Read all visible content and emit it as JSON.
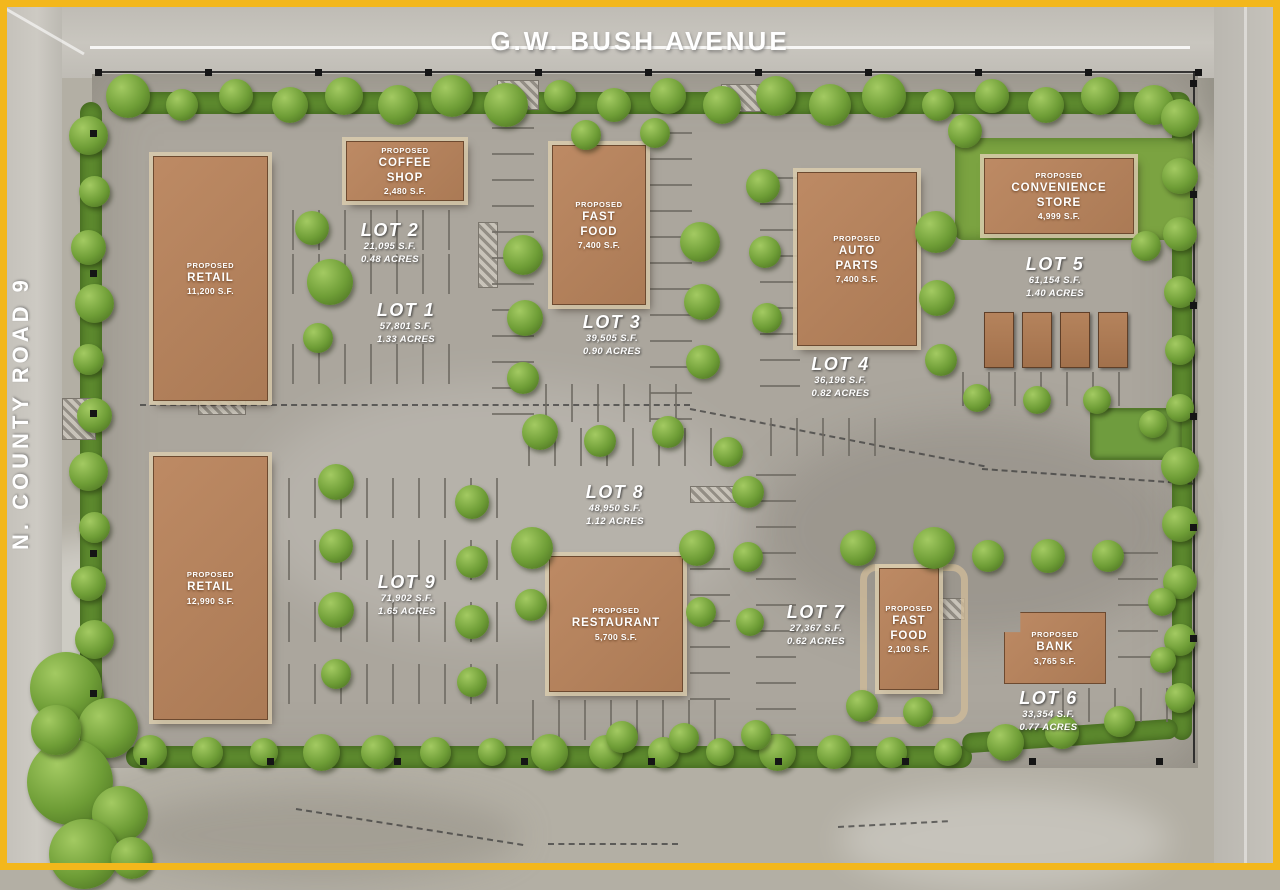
{
  "site": {
    "roads": {
      "top_label": "G.W. BUSH AVENUE",
      "left_label": "N. COUNTY ROAD 9"
    },
    "buildings": [
      {
        "id": "retail-north",
        "prefix": "PROPOSED",
        "name": "RETAIL",
        "size": "11,200 S.F."
      },
      {
        "id": "coffee-shop",
        "prefix": "PROPOSED",
        "name": "COFFEE\nSHOP",
        "size": "2,480 S.F."
      },
      {
        "id": "fast-food-north",
        "prefix": "PROPOSED",
        "name": "FAST\nFOOD",
        "size": "7,400 S.F."
      },
      {
        "id": "auto-parts",
        "prefix": "PROPOSED",
        "name": "AUTO\nPARTS",
        "size": "7,400 S.F."
      },
      {
        "id": "convenience-store",
        "prefix": "PROPOSED",
        "name": "CONVENIENCE\nSTORE",
        "size": "4,999 S.F."
      },
      {
        "id": "retail-south",
        "prefix": "PROPOSED",
        "name": "RETAIL",
        "size": "12,990 S.F."
      },
      {
        "id": "restaurant",
        "prefix": "PROPOSED",
        "name": "RESTAURANT",
        "size": "5,700 S.F."
      },
      {
        "id": "fast-food-south",
        "prefix": "PROPOSED",
        "name": "FAST\nFOOD",
        "size": "2,100 S.F."
      },
      {
        "id": "bank",
        "prefix": "PROPOSED",
        "name": "BANK",
        "size": "3,765 S.F."
      }
    ],
    "lots": [
      {
        "name": "LOT 1",
        "sf": "57,801 S.F.",
        "acres": "1.33 ACRES"
      },
      {
        "name": "LOT 2",
        "sf": "21,095 S.F.",
        "acres": "0.48 ACRES"
      },
      {
        "name": "LOT 3",
        "sf": "39,505 S.F.",
        "acres": "0.90 ACRES"
      },
      {
        "name": "LOT 4",
        "sf": "36,196 S.F.",
        "acres": "0.82 ACRES"
      },
      {
        "name": "LOT 5",
        "sf": "61,154 S.F.",
        "acres": "1.40 ACRES"
      },
      {
        "name": "LOT 6",
        "sf": "33,354 S.F.",
        "acres": "0.77 ACRES"
      },
      {
        "name": "LOT 7",
        "sf": "27,367 S.F.",
        "acres": "0.62 ACRES"
      },
      {
        "name": "LOT 8",
        "sf": "48,950 S.F.",
        "acres": "1.12 ACRES"
      },
      {
        "name": "LOT 9",
        "sf": "71,902 S.F.",
        "acres": "1.65 ACRES"
      }
    ],
    "colors": {
      "frame": "#f3b71c",
      "building": "#b08261",
      "tree_canopy": "#6e9d36",
      "pavement": "#aba69d"
    }
  }
}
